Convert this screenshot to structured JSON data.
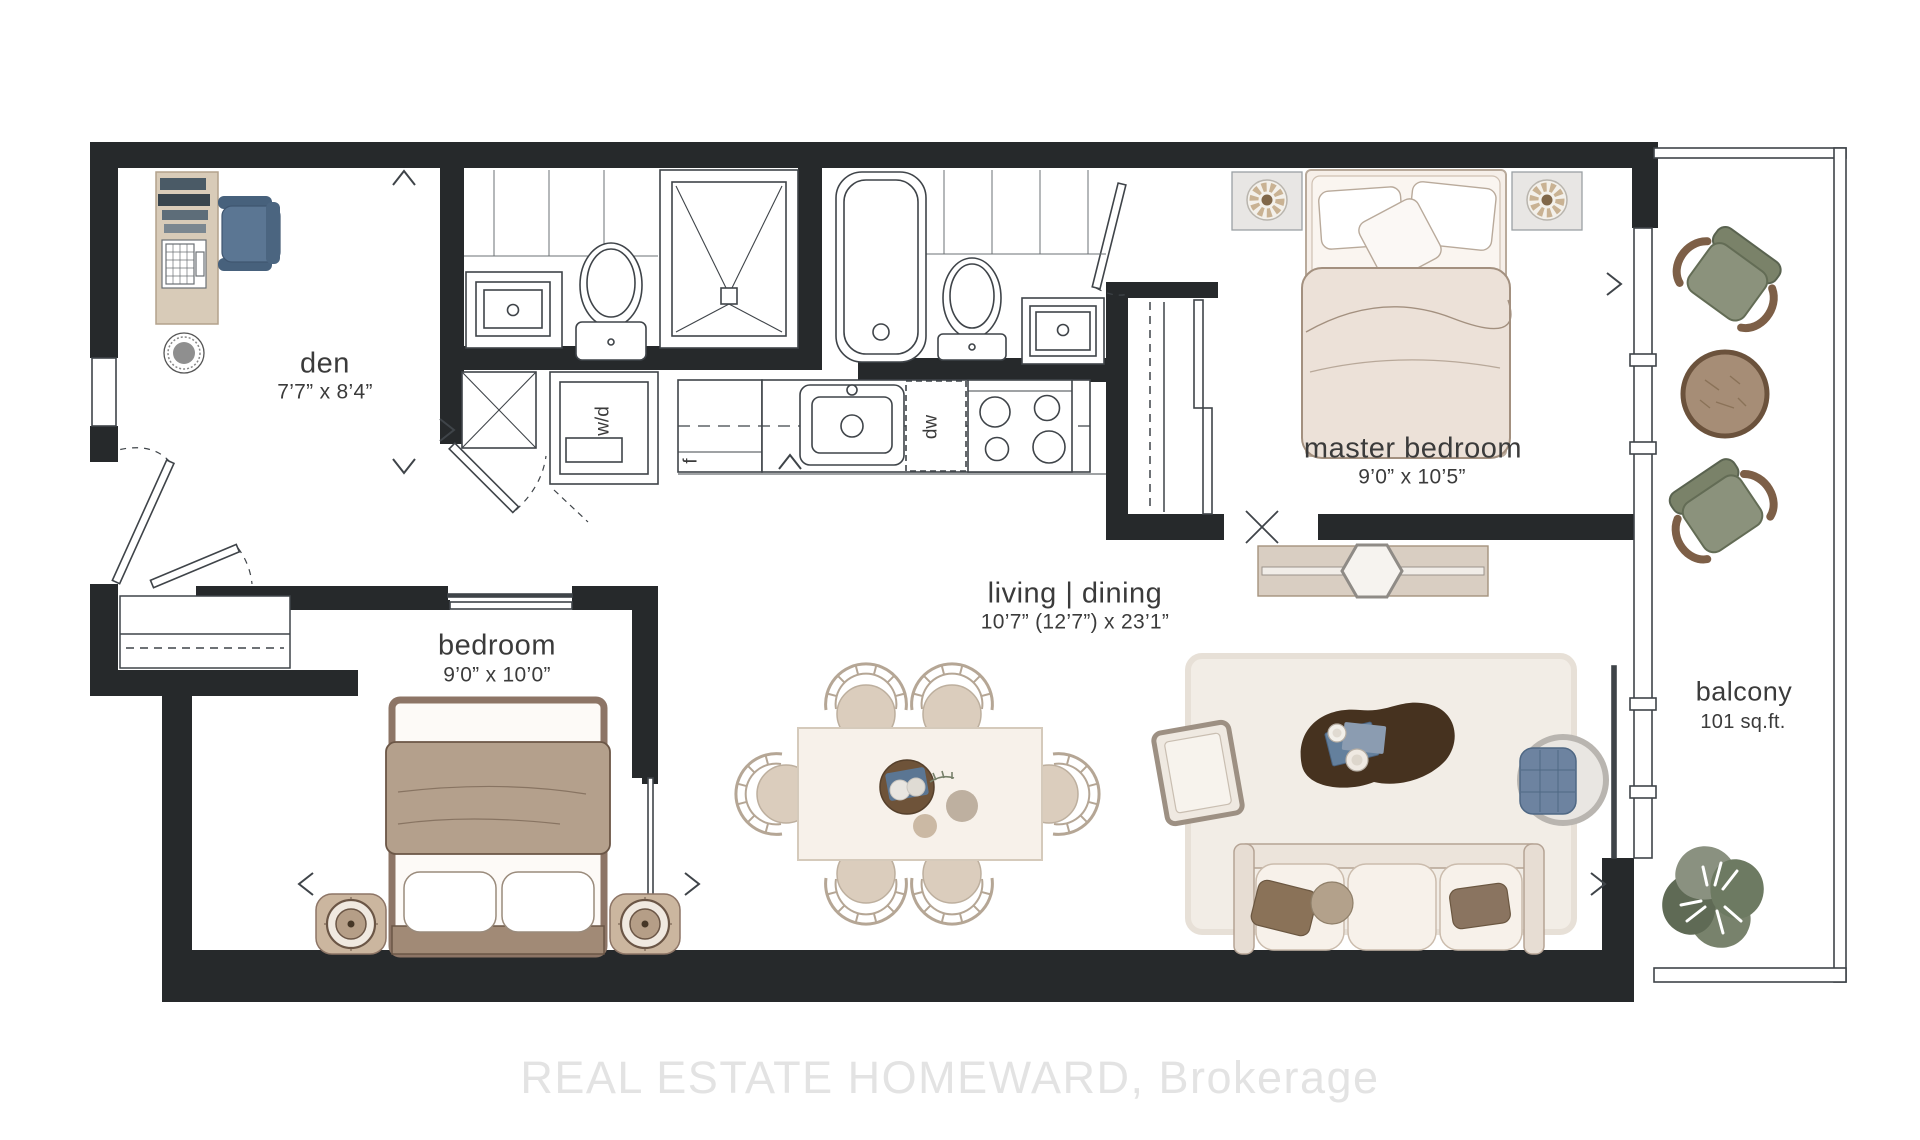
{
  "watermark": {
    "text": "REAL ESTATE HOMEWARD, Brokerage"
  },
  "rooms": {
    "den": {
      "name": "den",
      "dims": "7’7” x 8’4”"
    },
    "bedroom": {
      "name": "bedroom",
      "dims": "9’0” x 10’0”"
    },
    "master_bedroom": {
      "name": "master bedroom",
      "dims": "9’0” x 10’5”"
    },
    "living_dining": {
      "name": "living | dining",
      "dims": "10’7” (12’7”) x 23’1”"
    },
    "balcony": {
      "name": "balcony",
      "dims": "101 sq.ft."
    }
  },
  "appliances": {
    "fridge": "f",
    "dishwasher": "dw",
    "washer_dryer": "w/d"
  },
  "palette": {
    "wall": "#26292b",
    "label_text": "#3b3b3b",
    "accent_blue": "#5b7693",
    "balcony_green": "#8b927c",
    "wood_dark": "#46321f",
    "wood_mid": "#6e5339",
    "cream": "#f6f0e9",
    "tan_blanket": "#b4a08c",
    "watermark_gray": "#e3e3e3"
  }
}
